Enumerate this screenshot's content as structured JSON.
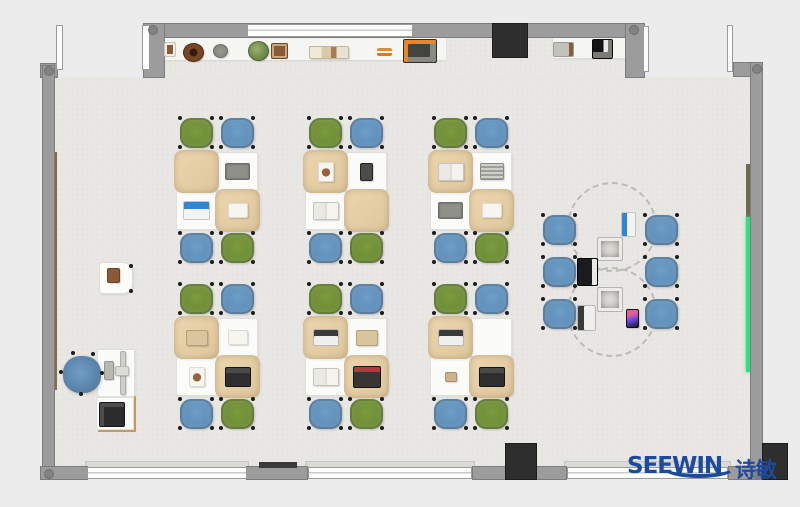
{
  "logo": {
    "text": "SEEWIN",
    "cn": "诗敏",
    "color": "#1b4a9e"
  },
  "palette": {
    "outside": "#ececec",
    "floor": "#e8e7e3",
    "shelf": "#f5f5f2",
    "wall": "#9c9c9c",
    "wall_border": "#7c7c7c",
    "cap": "#828282",
    "window": "#ffffff",
    "door": "#fdfdfd",
    "pillar": "#2e2e2e",
    "wood": "#8a6a42",
    "olive": "#6e6a50",
    "teal": "#33dd84",
    "desk": "#fbfbf9",
    "desk_cover": "#e6cfa7",
    "chair_green": "#6d8d33",
    "chair_blue": "#5e8fba",
    "logo_blue": "#1b4a9e"
  },
  "plan": {
    "floor": [
      {
        "x": 55,
        "y": 77,
        "w": 695,
        "h": 390
      },
      {
        "x": 163,
        "y": 38,
        "w": 462,
        "h": 40
      }
    ],
    "shelves": [
      {
        "x": 163,
        "y": 38,
        "w": 283,
        "h": 22
      },
      {
        "x": 553,
        "y": 38,
        "w": 74,
        "h": 20
      }
    ],
    "strips": [
      {
        "cls": "wood",
        "x": 52,
        "y": 152,
        "w": 5,
        "h": 238,
        "name": "wall-rail-wood"
      },
      {
        "cls": "olive",
        "x": 746,
        "y": 164,
        "w": 6,
        "h": 53,
        "name": "wall-board-olive"
      },
      {
        "cls": "teal",
        "x": 746,
        "y": 217,
        "w": 5,
        "h": 155,
        "name": "wall-led-strip"
      }
    ],
    "sills": [
      {
        "x": 85,
        "y": 461,
        "w": 164,
        "h": 7
      },
      {
        "x": 305,
        "y": 461,
        "w": 170,
        "h": 7
      },
      {
        "x": 564,
        "y": 461,
        "w": 167,
        "h": 7
      }
    ],
    "walls": [
      {
        "x": 143,
        "y": 23,
        "w": 502,
        "h": 15
      },
      {
        "x": 143,
        "y": 23,
        "w": 22,
        "h": 55
      },
      {
        "x": 625,
        "y": 23,
        "w": 20,
        "h": 55
      },
      {
        "x": 40,
        "y": 63,
        "w": 18,
        "h": 15
      },
      {
        "x": 42,
        "y": 65,
        "w": 13,
        "h": 404
      },
      {
        "x": 733,
        "y": 62,
        "w": 30,
        "h": 15
      },
      {
        "x": 750,
        "y": 62,
        "w": 13,
        "h": 406
      },
      {
        "x": 40,
        "y": 466,
        "w": 48,
        "h": 14
      },
      {
        "x": 246,
        "y": 466,
        "w": 62,
        "h": 14
      },
      {
        "x": 472,
        "y": 466,
        "w": 95,
        "h": 14
      },
      {
        "x": 728,
        "y": 466,
        "w": 34,
        "h": 14
      }
    ],
    "windows": [
      {
        "x": 247,
        "y": 24,
        "w": 166,
        "h": 13
      },
      {
        "x": 87,
        "y": 467,
        "w": 160,
        "h": 12
      },
      {
        "x": 308,
        "y": 467,
        "w": 164,
        "h": 12
      },
      {
        "x": 567,
        "y": 467,
        "w": 161,
        "h": 12
      }
    ],
    "doors": [
      {
        "x": 56,
        "y": 25,
        "w": 7,
        "h": 45
      },
      {
        "x": 142,
        "y": 25,
        "w": 8,
        "h": 45
      },
      {
        "x": 643,
        "y": 26,
        "w": 6,
        "h": 46
      },
      {
        "x": 727,
        "y": 25,
        "w": 6,
        "h": 47
      }
    ],
    "caps": [
      {
        "x": 148,
        "y": 25
      },
      {
        "x": 629,
        "y": 25
      },
      {
        "x": 44,
        "y": 66
      },
      {
        "x": 752,
        "y": 64
      },
      {
        "x": 44,
        "y": 469
      },
      {
        "x": 752,
        "y": 469
      }
    ],
    "pillars": [
      {
        "x": 492,
        "y": 23,
        "w": 36,
        "h": 35,
        "name": "wall-unit-dark"
      },
      {
        "x": 505,
        "y": 443,
        "w": 32,
        "h": 37,
        "name": "column-block"
      },
      {
        "x": 762,
        "y": 443,
        "w": 26,
        "h": 37,
        "name": "corner-block"
      }
    ],
    "darkbar": {
      "x": 259,
      "y": 462,
      "w": 38,
      "h": 6
    },
    "shelf_items": [
      {
        "k": "frame-small",
        "x": 164,
        "y": 42,
        "w": 12,
        "h": 15
      },
      {
        "k": "pot-ring",
        "x": 183,
        "y": 43,
        "w": 21,
        "h": 19
      },
      {
        "k": "pot-gray",
        "x": 213,
        "y": 44,
        "w": 15,
        "h": 14
      },
      {
        "k": "plant-green",
        "x": 248,
        "y": 41,
        "w": 21,
        "h": 20
      },
      {
        "k": "frame-photo",
        "x": 271,
        "y": 43,
        "w": 17,
        "h": 16
      },
      {
        "k": "books",
        "x": 309,
        "y": 46,
        "w": 40,
        "h": 13
      },
      {
        "k": "pencils",
        "x": 377,
        "y": 48,
        "w": 15,
        "h": 8
      },
      {
        "k": "tray",
        "x": 403,
        "y": 39,
        "w": 34,
        "h": 24
      },
      {
        "k": "box-gray",
        "x": 553,
        "y": 42,
        "w": 21,
        "h": 15
      },
      {
        "k": "machine",
        "x": 592,
        "y": 39,
        "w": 21,
        "h": 20
      }
    ],
    "cluster_geom": {
      "deskW": 41,
      "deskH": 39,
      "chairW": 33,
      "chairH": 30,
      "chairColors": [
        "green",
        "blue",
        "blue",
        "green"
      ],
      "covers": [
        0,
        3
      ]
    },
    "clusters": [
      {
        "x": 176,
        "y": 152,
        "items": [
          {
            "d": 1,
            "k": "laptop-gray"
          },
          {
            "d": 2,
            "k": "tablet-blue"
          },
          {
            "d": 3,
            "k": "paper"
          }
        ]
      },
      {
        "x": 305,
        "y": 152,
        "items": [
          {
            "d": 0,
            "k": "photo"
          },
          {
            "d": 1,
            "k": "tablet-dark"
          },
          {
            "d": 2,
            "k": "book-open"
          }
        ]
      },
      {
        "x": 430,
        "y": 152,
        "items": [
          {
            "d": 0,
            "k": "book-open"
          },
          {
            "d": 1,
            "k": "tablet-striped"
          },
          {
            "d": 2,
            "k": "laptop-gray"
          },
          {
            "d": 3,
            "k": "paper"
          }
        ]
      },
      {
        "x": 176,
        "y": 318,
        "items": [
          {
            "d": 0,
            "k": "book-tan"
          },
          {
            "d": 1,
            "k": "paper"
          },
          {
            "d": 2,
            "k": "photo"
          },
          {
            "d": 3,
            "k": "laptop-dark"
          }
        ]
      },
      {
        "x": 305,
        "y": 318,
        "items": [
          {
            "d": 0,
            "k": "laptop-white"
          },
          {
            "d": 1,
            "k": "book-tan"
          },
          {
            "d": 2,
            "k": "book-open"
          },
          {
            "d": 3,
            "k": "laptop-red"
          }
        ]
      },
      {
        "x": 430,
        "y": 318,
        "items": [
          {
            "d": 0,
            "k": "laptop-white"
          },
          {
            "d": 2,
            "k": "box-tan"
          },
          {
            "d": 3,
            "k": "laptop-dark"
          }
        ]
      }
    ],
    "collab": {
      "circles": [
        {
          "cx": 612,
          "cy": 227,
          "r": 45
        },
        {
          "cx": 612,
          "cy": 312,
          "r": 45
        }
      ],
      "chairs": [
        {
          "x": 543,
          "y": 215
        },
        {
          "x": 543,
          "y": 257
        },
        {
          "x": 543,
          "y": 299
        },
        {
          "x": 645,
          "y": 215
        },
        {
          "x": 645,
          "y": 257
        },
        {
          "x": 645,
          "y": 299
        }
      ],
      "items": [
        {
          "k": "tablet-blue-v",
          "x": 621,
          "y": 212,
          "w": 15,
          "h": 25
        },
        {
          "k": "device-photo",
          "x": 597,
          "y": 237,
          "w": 26,
          "h": 24
        },
        {
          "k": "laptop-black",
          "x": 577,
          "y": 258,
          "w": 21,
          "h": 28
        },
        {
          "k": "device-photo",
          "x": 597,
          "y": 287,
          "w": 26,
          "h": 25
        },
        {
          "k": "laptop-white-v",
          "x": 577,
          "y": 305,
          "w": 19,
          "h": 26
        },
        {
          "k": "phone-color",
          "x": 626,
          "y": 309,
          "w": 13,
          "h": 19
        }
      ]
    },
    "teacher": {
      "cabinet": {
        "x": 99,
        "y": 262,
        "w": 34,
        "h": 32
      },
      "cabinet_item": {
        "x": 107,
        "y": 268,
        "w": 13,
        "h": 15
      },
      "cabinet_dots": [
        [
          129,
          264
        ],
        [
          129,
          289
        ]
      ],
      "chair": {
        "x": 63,
        "y": 356,
        "w": 38,
        "h": 37
      },
      "chair_dots": [
        [
          59,
          370
        ],
        [
          71,
          351
        ],
        [
          91,
          352
        ],
        [
          100,
          371
        ],
        [
          79,
          392
        ]
      ],
      "desk": {
        "x": 97,
        "y": 349,
        "w": 38,
        "h": 48
      },
      "monitor": {
        "x": 120,
        "y": 351,
        "w": 6,
        "h": 44
      },
      "monitor_base": {
        "x": 115,
        "y": 366,
        "w": 14,
        "h": 10
      },
      "keyboard": {
        "x": 104,
        "y": 361,
        "w": 10,
        "h": 19
      },
      "printer_table": {
        "x": 96,
        "y": 397,
        "w": 38,
        "h": 33
      },
      "printer": {
        "x": 99,
        "y": 402,
        "w": 26,
        "h": 25
      },
      "edges": [
        {
          "x": 134,
          "y": 396,
          "w": 2,
          "h": 36
        },
        {
          "x": 98,
          "y": 430,
          "w": 38,
          "h": 2
        }
      ]
    }
  }
}
